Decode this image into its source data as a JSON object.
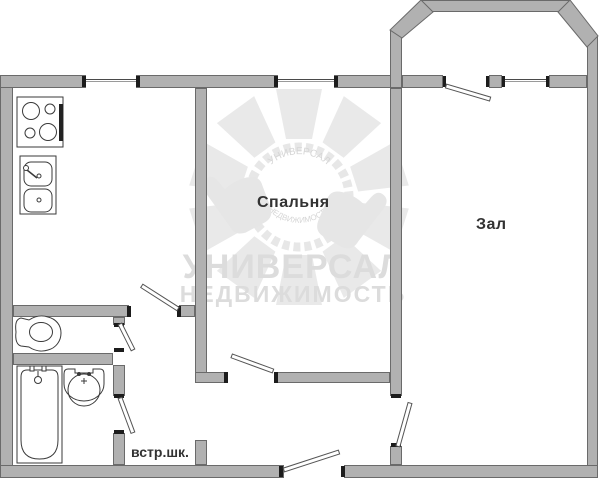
{
  "type": "apartment-floor-plan",
  "rooms": {
    "bedroom": {
      "label": "Спальня"
    },
    "hall": {
      "label": "Зал"
    },
    "wardrobe": {
      "label": "встр.шк."
    }
  },
  "fixtures": [
    "stove-icon",
    "kitchen-sink-icon",
    "toilet-icon",
    "bathtub-icon",
    "bath-sink-icon"
  ],
  "watermark": {
    "line1": "УНИВЕРСАЛ",
    "line2": "НЕДВИЖИМОСТЬ",
    "logo": "sun-rays-gear-with-thumbs-up"
  },
  "colors": {
    "wall_fill": "#b1b1b1",
    "wall_border": "#6a6a6a",
    "fixture_line": "#3a3a3a",
    "label_text": "#333333",
    "watermark_text": "#dcdcdc",
    "background": "#ffffff"
  }
}
